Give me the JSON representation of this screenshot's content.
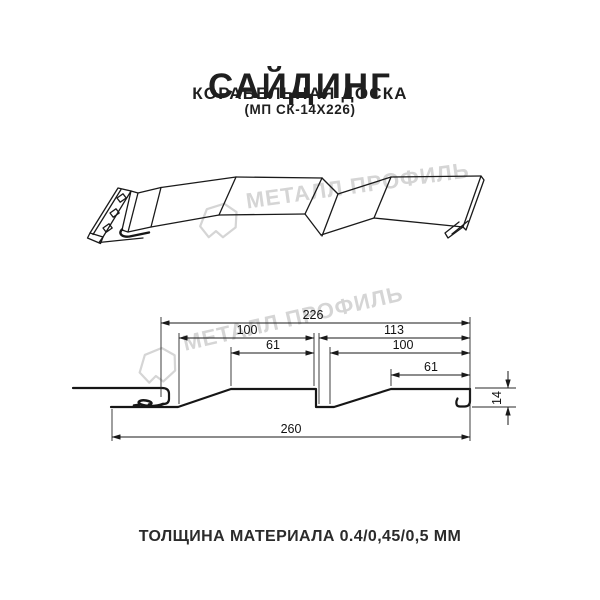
{
  "header": {
    "title": "САЙДИНГ",
    "subtitle": "КОРАБЕЛЬНАЯ ДОСКА",
    "code": "(МП СК-14Х226)"
  },
  "watermark": {
    "brand": "МЕТАЛЛ ПРОФИЛЬ"
  },
  "drawing": {
    "dims": {
      "top_width": "226",
      "left_outer": "100",
      "left_inner": "61",
      "right_outer": "113",
      "right_mid": "100",
      "right_inner": "61",
      "bottom_width": "260",
      "height": "14"
    }
  },
  "footer": {
    "text": "ТОЛЩИНА МАТЕРИАЛА 0.4/0,45/0,5 ММ"
  },
  "colors": {
    "line": "#161616",
    "watermark": "#d5d5d5",
    "text": "#1f1f1f"
  }
}
